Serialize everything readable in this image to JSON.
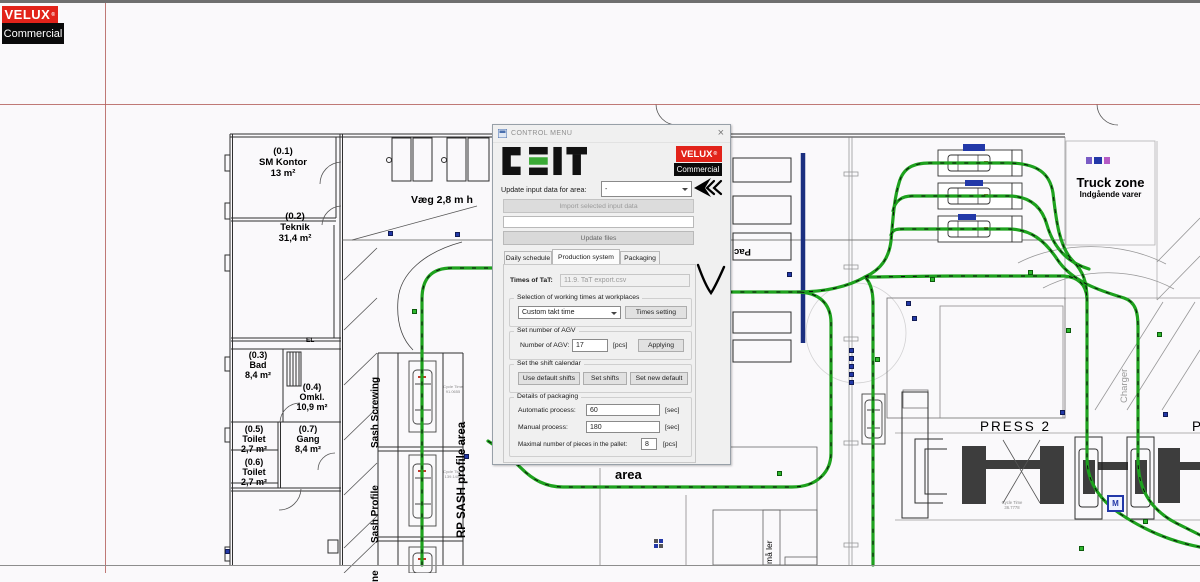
{
  "brand": {
    "velux": "VELUX",
    "registered": "®",
    "commercial": "Commercial"
  },
  "dialog": {
    "title": "CONTROL MENU",
    "close_glyph": "×",
    "update_area_label": "Update input data for area:",
    "area_value": "-",
    "import_button": "Import selected input data",
    "update_files_button": "Update files",
    "tabs": [
      "Daily schedule",
      "Production system",
      "Packaging"
    ],
    "times_of_tat_label": "Times of TaT:",
    "times_of_tat_value": "11.9. TaT export.csv",
    "group_working_times": "Selection of working times at workplaces",
    "takt_combo_value": "Custom takt time",
    "times_setting_button": "Times setting",
    "group_agv": "Set number of AGV",
    "agv_label": "Number of AGV:",
    "agv_value": "17",
    "agv_unit": "[pcs]",
    "applying_button": "Applying",
    "group_shift": "Set the shift calendar",
    "shift_buttons": [
      "Use default shifts",
      "Set shifts",
      "Set new default"
    ],
    "group_packaging": "Details of packaging",
    "auto_label": "Automatic process:",
    "auto_value": "60",
    "auto_unit": "[sec]",
    "manual_label": "Manual process:",
    "manual_value": "180",
    "manual_unit": "[sec]",
    "pallet_label": "Maximal number of pieces in the pallet:",
    "pallet_value": "8",
    "pallet_unit": "[pcs]"
  },
  "plan": {
    "vaeg_label": "Væg 2,8 m h",
    "rooms": [
      {
        "num": "(0.1)",
        "name": "SM Kontor",
        "area": "13 m²"
      },
      {
        "num": "(0.2)",
        "name": "Teknik",
        "area": "31,4 m²"
      },
      {
        "num": "(0.3)",
        "name": "Bad",
        "area": "8,4 m²"
      },
      {
        "num": "(0.4)",
        "name": "Omkl.",
        "area": "10,9 m²"
      },
      {
        "num": "(0.5)",
        "name": "Toilet",
        "area": "2,7 m²"
      },
      {
        "num": "(0.7)",
        "name": "Gang",
        "area": "8,4 m²"
      },
      {
        "num": "(0.6)",
        "name": "Toilet",
        "area": "2,7 m²"
      }
    ],
    "sash_screwing": "Sash Screwing",
    "sash_profile": "Sash Profile",
    "sash_partial": "ne",
    "rp_sash": "RP SASH profile area",
    "truck_zone": "Truck zone",
    "truck_zone_sub": "Indgående varer",
    "press2": "PRESS 2",
    "press_partial": "P",
    "tailormade_line1": "Tailormade",
    "tailormade_line2": "area",
    "pac": "Pac",
    "charger": "Charger",
    "el": "EL",
    "pallet_text": "må ler",
    "m_marker": "M",
    "cycle_time": "Cycle Time",
    "cycle_values": [
      "91.0655",
      "139.1405",
      "36.7778"
    ]
  },
  "colors": {
    "velux_red": "#e2231a",
    "ceit_green": "#3aaa35",
    "path_green": "#1ea21e",
    "navy_line": "#1b2f80",
    "grid_red": "#b4635e"
  }
}
